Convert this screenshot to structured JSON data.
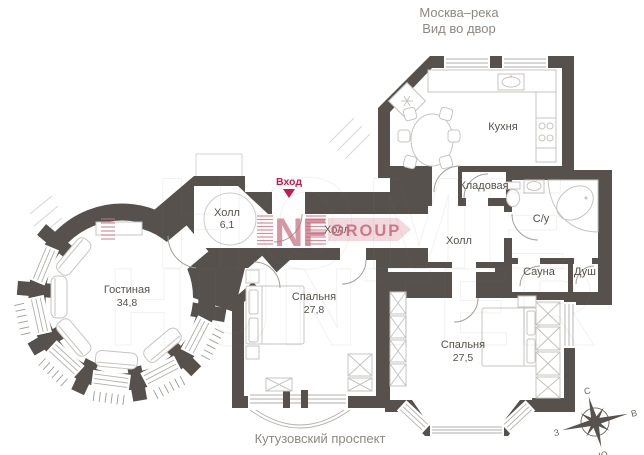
{
  "header": {
    "l1": "Москва–река",
    "l2": "Вид во двор"
  },
  "street": "Кутузовский проспект",
  "entrance": "Вход",
  "rooms": {
    "living": {
      "name": "Гостиная",
      "area": "34,8"
    },
    "hallEntry": {
      "name": "Холл",
      "area": "6,1"
    },
    "hallMid": {
      "name": "Холл"
    },
    "hallCentral": {
      "name": "Холл"
    },
    "kitchen": {
      "name": "Кухня"
    },
    "storage": {
      "name": "Кладовая"
    },
    "bath": {
      "name": "С/у"
    },
    "sauna": {
      "name": "Сауна"
    },
    "shower": {
      "name": "Душ"
    },
    "bedroom1": {
      "name": "Спальня",
      "area": "27,8"
    },
    "bedroom2": {
      "name": "Спальня",
      "area": "27,5"
    }
  },
  "compass": {
    "n": "С",
    "e": "В",
    "s": "Ю",
    "w": "З"
  },
  "logo": {
    "mark": "NF",
    "group": "GROUP"
  },
  "watermark": {
    "l1": "HOME",
    "l2": "HUNTER"
  },
  "colors": {
    "wall": "#56514c",
    "accent_red": "#c51a4b",
    "logo_pink": "#c96e80",
    "muted_text": "#8d8882"
  }
}
